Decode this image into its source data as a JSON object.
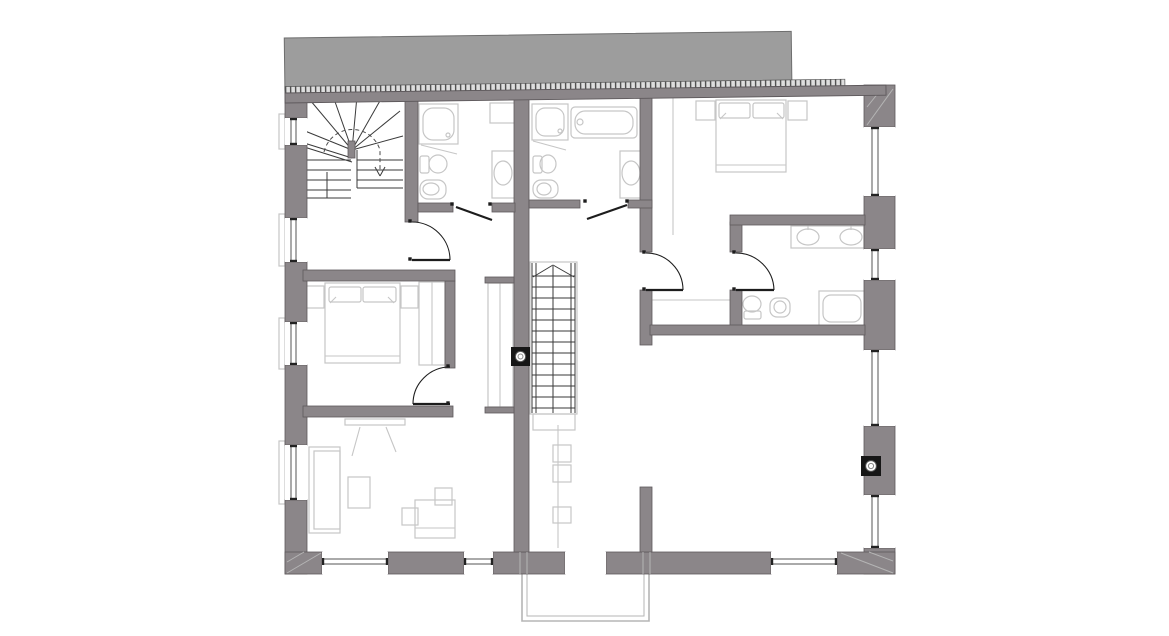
{
  "meta": {
    "width": 1169,
    "height": 636
  },
  "colors": {
    "bg": "#ffffff",
    "wall": "#8b8689",
    "wallEdge": "#5e595c",
    "roof": "#9d9d9d",
    "roofEdge": "#6e6e6e",
    "hatchBg": "#dedede",
    "hatchTick": "#4f4f4f",
    "light": "#c6c6c6",
    "mid": "#b5b5b5",
    "dark": "#3a3a3a",
    "door": "#1d1d1d",
    "window": "#ffffff",
    "frame": "#555555",
    "cap": "#222222"
  },
  "roof": {
    "rot": -0.75,
    "ox": 285,
    "oy": 95,
    "block": [
      285,
      38,
      507,
      52
    ],
    "hatch": [
      285,
      86.5,
      560,
      6.5
    ],
    "band": [
      285,
      93,
      601,
      10
    ]
  },
  "balcony": [
    "M522,570 L522,621 L649,621 L649,570",
    "M527,570 L527,616 L644,616 L644,570"
  ],
  "walls": [
    [
      285,
      90,
      22,
      28,
      "left-pier-1"
    ],
    [
      285,
      145,
      22,
      73,
      "left-pier-2"
    ],
    [
      285,
      262,
      22,
      60,
      "left-pier-3"
    ],
    [
      285,
      365,
      22,
      80,
      "left-pier-4"
    ],
    [
      285,
      500,
      22,
      74,
      "left-pier-5"
    ],
    [
      864,
      85,
      31,
      42,
      "right-pier-1"
    ],
    [
      864,
      196,
      31,
      53,
      "right-pier-2"
    ],
    [
      864,
      280,
      31,
      70,
      "right-pier-3"
    ],
    [
      864,
      426,
      31,
      69,
      "right-pier-4"
    ],
    [
      864,
      548,
      31,
      26,
      "right-pier-5"
    ],
    [
      285,
      552,
      37,
      22,
      "bottom-wall-seg-1"
    ],
    [
      388,
      552,
      76,
      22,
      "bottom-wall-seg-2"
    ],
    [
      493,
      552,
      72,
      22,
      "bottom-wall-seg-3"
    ],
    [
      606,
      552,
      165,
      22,
      "bottom-wall-seg-4"
    ],
    [
      837,
      552,
      58,
      22,
      "bottom-wall-seg-5"
    ],
    [
      405,
      95,
      13,
      127,
      "stairhall-east-wall"
    ],
    [
      514,
      95,
      15,
      457,
      "central-spine-wall"
    ],
    [
      640,
      95,
      12,
      157,
      "corridor-east-wall-upper"
    ],
    [
      640,
      290,
      12,
      55,
      "corridor-east-wall-mid"
    ],
    [
      640,
      487,
      12,
      65,
      "corridor-east-wall-lower"
    ],
    [
      445,
      281,
      10,
      87,
      "bedroom-left-east-wall"
    ],
    [
      730,
      222,
      12,
      30,
      "ensuite-west-stub-upper"
    ],
    [
      730,
      290,
      12,
      40,
      "ensuite-west-stub-lower"
    ],
    [
      303,
      270,
      152,
      11,
      "bedroom-left-north-wall"
    ],
    [
      303,
      406,
      150,
      11,
      "bedroom-left-south-wall"
    ],
    [
      418,
      203,
      35,
      9,
      "bath1-south-wall-a"
    ],
    [
      492,
      203,
      23,
      9,
      "bath1-south-wall-b"
    ],
    [
      529,
      200,
      51,
      8,
      "bath2-south-wall-a"
    ],
    [
      628,
      200,
      24,
      8,
      "bath2-south-wall-b"
    ],
    [
      730,
      215,
      135,
      10,
      "ensuite-north-wall"
    ],
    [
      650,
      325,
      215,
      10,
      "ensuite-south-wall"
    ],
    [
      485,
      277,
      29,
      6,
      "closet-stub-north"
    ],
    [
      485,
      407,
      29,
      6,
      "closet-stub-south"
    ],
    [
      348,
      141,
      7,
      17,
      "winder-newel"
    ]
  ],
  "windows": [
    {
      "o": "v",
      "x": 285,
      "y": 118,
      "w": 22,
      "h": 27,
      "f": [
        291,
        296
      ],
      "n": "window-left-1"
    },
    {
      "o": "v",
      "x": 285,
      "y": 218,
      "w": 22,
      "h": 44,
      "f": [
        291,
        296
      ],
      "n": "window-left-2"
    },
    {
      "o": "v",
      "x": 285,
      "y": 322,
      "w": 22,
      "h": 43,
      "f": [
        291,
        296
      ],
      "n": "window-left-3"
    },
    {
      "o": "v",
      "x": 285,
      "y": 445,
      "w": 22,
      "h": 55,
      "f": [
        291,
        296
      ],
      "n": "window-left-4"
    },
    {
      "o": "v",
      "x": 864,
      "y": 127,
      "w": 31,
      "h": 69,
      "f": [
        872,
        878
      ],
      "n": "window-right-1"
    },
    {
      "o": "v",
      "x": 864,
      "y": 249,
      "w": 31,
      "h": 31,
      "f": [
        872,
        878
      ],
      "n": "window-right-2"
    },
    {
      "o": "v",
      "x": 864,
      "y": 350,
      "w": 31,
      "h": 76,
      "f": [
        872,
        878
      ],
      "n": "window-right-3"
    },
    {
      "o": "v",
      "x": 864,
      "y": 495,
      "w": 31,
      "h": 53,
      "f": [
        872,
        878
      ],
      "n": "window-right-4"
    },
    {
      "o": "h",
      "x": 322,
      "y": 552,
      "w": 66,
      "h": 22,
      "f": [
        559,
        564
      ],
      "n": "window-bottom-1"
    },
    {
      "o": "h",
      "x": 464,
      "y": 552,
      "w": 29,
      "h": 22,
      "f": [
        559,
        564
      ],
      "n": "window-bottom-2"
    },
    {
      "o": "h",
      "x": 771,
      "y": 552,
      "w": 66,
      "h": 22,
      "f": [
        559,
        564
      ],
      "n": "window-bottom-3"
    },
    {
      "o": "h",
      "x": 565,
      "y": 552,
      "w": 41,
      "h": 22,
      "f": [],
      "n": "balcony-door-opening"
    }
  ],
  "lightRects": [
    [
      419,
      104,
      39,
      40,
      0,
      "shower-tray-1"
    ],
    [
      423,
      108,
      31,
      32,
      10,
      "shower-tray-1-inner"
    ],
    [
      532,
      104,
      36,
      36,
      0,
      "shower-tray-2"
    ],
    [
      536,
      108,
      28,
      28,
      9,
      "shower-tray-2-inner"
    ],
    [
      819,
      291,
      46,
      35,
      0,
      "shower-tray-3"
    ],
    [
      823,
      295,
      38,
      27,
      8,
      "shower-tray-3-inner"
    ],
    [
      571,
      107,
      66,
      31,
      4,
      "bathtub"
    ],
    [
      575,
      111,
      58,
      23,
      10,
      "bathtub-inner"
    ],
    [
      492,
      151,
      23,
      47,
      0,
      "bath1-sink-counter"
    ],
    [
      620,
      151,
      22,
      47,
      0,
      "bath2-sink-counter"
    ],
    [
      791,
      226,
      73,
      22,
      0,
      "ensuite-vanity"
    ],
    [
      490,
      103,
      25,
      20,
      0,
      "bath1-shelf"
    ],
    [
      420,
      156,
      9,
      17,
      2,
      "toilet1-tank"
    ],
    [
      533,
      156,
      9,
      17,
      2,
      "toilet2-tank"
    ],
    [
      420,
      180,
      26,
      19,
      8,
      "bidet1-body"
    ],
    [
      533,
      180,
      25,
      18,
      8,
      "bidet2-body"
    ],
    [
      744,
      311,
      17,
      8,
      2,
      "toilet3-tank"
    ],
    [
      770,
      298,
      20,
      19,
      7,
      "bidet3-body"
    ],
    [
      325,
      283,
      75,
      80,
      0,
      "bed-left"
    ],
    [
      329,
      287,
      32,
      15,
      2,
      "bed-left-pillow-1"
    ],
    [
      363,
      287,
      33,
      15,
      2,
      "bed-left-pillow-2"
    ],
    [
      306,
      286,
      18,
      22,
      0,
      "nightstand-left-1"
    ],
    [
      401,
      286,
      17,
      22,
      0,
      "nightstand-left-2"
    ],
    [
      419,
      282,
      26,
      83,
      0,
      "wardrobe-left"
    ],
    [
      716,
      100,
      70,
      72,
      0,
      "bed-right"
    ],
    [
      719,
      103,
      31,
      15,
      2,
      "bed-right-pillow-1"
    ],
    [
      753,
      103,
      31,
      15,
      2,
      "bed-right-pillow-2"
    ],
    [
      696,
      101,
      19,
      19,
      0,
      "nightstand-right-1"
    ],
    [
      788,
      101,
      19,
      19,
      0,
      "nightstand-right-2"
    ],
    [
      488,
      283,
      25,
      124,
      0,
      "corridor-closet"
    ],
    [
      309,
      447,
      31,
      86,
      0,
      "sofa"
    ],
    [
      314,
      451,
      26,
      78,
      0,
      "sofa-inner"
    ],
    [
      348,
      477,
      22,
      31,
      0,
      "coffee-table"
    ],
    [
      435,
      488,
      17,
      17,
      0,
      "side-table"
    ],
    [
      415,
      500,
      40,
      38,
      0,
      "desk"
    ],
    [
      402,
      508,
      16,
      17,
      0,
      "desk-chair"
    ],
    [
      553,
      445,
      18,
      17,
      0,
      "corridor-box-1"
    ],
    [
      553,
      465,
      18,
      17,
      0,
      "corridor-box-2"
    ],
    [
      553,
      507,
      18,
      16,
      0,
      "corridor-box-3"
    ],
    [
      530,
      262,
      47,
      152,
      0,
      "stair-outline"
    ],
    [
      533,
      414,
      42,
      16,
      0,
      "stair-landing-outline"
    ],
    [
      345,
      419,
      60,
      6,
      0,
      "tv"
    ],
    [
      279,
      114,
      6,
      35,
      0,
      "sill-left-1"
    ],
    [
      279,
      214,
      6,
      52,
      0,
      "sill-left-2"
    ],
    [
      279,
      318,
      6,
      51,
      0,
      "sill-left-3"
    ],
    [
      279,
      441,
      6,
      63,
      0,
      "sill-left-4"
    ]
  ],
  "lightEllipses": [
    [
      503,
      173,
      9,
      12,
      "bath1-sink-bowl"
    ],
    [
      631,
      173,
      9,
      12,
      "bath2-sink-bowl"
    ],
    [
      808,
      237,
      11,
      8,
      "vanity-sink-1"
    ],
    [
      851,
      237,
      11,
      8,
      "vanity-sink-2"
    ],
    [
      438,
      164,
      9,
      9,
      "toilet1-bowl"
    ],
    [
      548,
      164,
      8,
      9,
      "toilet2-bowl"
    ],
    [
      431,
      189,
      8,
      6,
      "bidet1-bowl"
    ],
    [
      544,
      189,
      7,
      6,
      "bidet2-bowl"
    ],
    [
      752,
      304,
      9,
      8,
      "toilet3-bowl"
    ],
    [
      780,
      307,
      6,
      6,
      "bidet3-bowl"
    ],
    [
      580,
      122,
      3,
      3,
      "bathtub-faucet"
    ],
    [
      448,
      135,
      2,
      2,
      "shower1-drain"
    ],
    [
      560,
      131,
      2,
      2,
      "shower2-drain"
    ]
  ],
  "lightLines": [
    [
      421,
      145,
      457,
      154
    ],
    [
      533,
      141,
      566,
      150
    ],
    [
      330,
      303,
      336,
      297
    ],
    [
      394,
      303,
      388,
      297
    ],
    [
      720,
      119,
      726,
      113
    ],
    [
      783,
      119,
      777,
      113
    ],
    [
      325,
      356,
      400,
      356
    ],
    [
      716,
      165,
      786,
      165
    ],
    [
      360,
      427,
      352,
      456
    ],
    [
      386,
      427,
      396,
      452
    ],
    [
      415,
      528,
      455,
      528
    ],
    [
      673,
      98,
      673,
      235
    ],
    [
      652,
      300,
      730,
      300
    ],
    [
      558,
      425,
      558,
      548
    ],
    [
      432,
      282,
      432,
      365
    ],
    [
      500,
      283,
      500,
      407
    ],
    [
      808,
      230,
      808,
      225
    ],
    [
      851,
      230,
      851,
      225
    ]
  ],
  "darkLines": [
    [
      352,
      150,
      305,
      131
    ],
    [
      352,
      150,
      310,
      100
    ],
    [
      352,
      150,
      333,
      96
    ],
    [
      352,
      150,
      357,
      96
    ],
    [
      352,
      150,
      381,
      99
    ],
    [
      352,
      150,
      400,
      111
    ],
    [
      352,
      150,
      403,
      136
    ],
    [
      307,
      160,
      351,
      160
    ],
    [
      307,
      170,
      351,
      170
    ],
    [
      307,
      180,
      351,
      180
    ],
    [
      307,
      190,
      351,
      190
    ],
    [
      307,
      198,
      351,
      198
    ],
    [
      327,
      172,
      327,
      198
    ],
    [
      357,
      160,
      403,
      160
    ],
    [
      357,
      170,
      403,
      170
    ],
    [
      357,
      180,
      403,
      180
    ],
    [
      357,
      188,
      403,
      188
    ],
    [
      357,
      150,
      357,
      188
    ],
    [
      301,
      146,
      352,
      162
    ],
    [
      301,
      142,
      352,
      158
    ],
    [
      375,
      167,
      380,
      176
    ],
    [
      385,
      167,
      380,
      176
    ],
    [
      532,
      263,
      532,
      413
    ],
    [
      536,
      263,
      536,
      413
    ],
    [
      571,
      263,
      571,
      413
    ],
    [
      575,
      263,
      575,
      413
    ],
    [
      553,
      266,
      553,
      413
    ],
    [
      532,
      276,
      575,
      276
    ],
    [
      532,
      287,
      575,
      287
    ],
    [
      532,
      298,
      575,
      298
    ],
    [
      532,
      309,
      575,
      309
    ],
    [
      532,
      320,
      575,
      320
    ],
    [
      532,
      331,
      575,
      331
    ],
    [
      532,
      342,
      575,
      342
    ],
    [
      532,
      353,
      575,
      353
    ],
    [
      532,
      364,
      575,
      364
    ],
    [
      532,
      375,
      575,
      375
    ],
    [
      532,
      386,
      575,
      386
    ],
    [
      532,
      397,
      575,
      397
    ],
    [
      532,
      408,
      575,
      408
    ],
    [
      533,
      277,
      553,
      265
    ],
    [
      553,
      265,
      574,
      277
    ]
  ],
  "dashedPaths": [
    "M324,152 A29,29 0 0 1 380,150 L380,172"
  ],
  "overLines": [
    [
      287,
      573,
      321,
      553
    ],
    [
      287,
      562,
      304,
      552
    ],
    [
      893,
      573,
      841,
      553
    ],
    [
      893,
      561,
      869,
      552
    ],
    [
      867,
      125,
      893,
      89
    ],
    [
      867,
      107,
      883,
      87
    ],
    [
      520,
      552,
      520,
      574
    ],
    [
      527,
      552,
      527,
      574
    ],
    [
      643,
      552,
      643,
      574
    ],
    [
      650,
      552,
      650,
      574
    ]
  ],
  "doorArcs": [
    "M412,222 A38,38 0 0 1 450,260",
    "M450,367 A37,37 0 0 0 413,404",
    "M646,253 A37,37 0 0 1 683,290",
    "M736,253 A38,38 0 0 1 774,290"
  ],
  "doorLeaves": [
    [
      412,
      260,
      450,
      260,
      "door-stairhall-leaf"
    ],
    [
      450,
      404,
      413,
      404,
      "door-bedroom-left-leaf"
    ],
    [
      646,
      290,
      683,
      290,
      "door-landing-bedroom-leaf"
    ],
    [
      736,
      290,
      774,
      290,
      "door-ensuite-leaf"
    ],
    [
      456,
      207,
      492,
      220,
      "door-bath1-leaf"
    ],
    [
      627,
      205,
      587,
      219,
      "door-bath2-leaf"
    ]
  ],
  "doorDots": [
    [
      410,
      221
    ],
    [
      410,
      259
    ],
    [
      448,
      366
    ],
    [
      448,
      403
    ],
    [
      644,
      252
    ],
    [
      644,
      289
    ],
    [
      734,
      252
    ],
    [
      734,
      289
    ],
    [
      452,
      204
    ],
    [
      490,
      204
    ],
    [
      585,
      201
    ],
    [
      627,
      201
    ]
  ],
  "columns": [
    [
      520.5,
      356.5,
      19,
      "column-symbol-1"
    ],
    [
      871,
      466,
      20,
      "column-symbol-2"
    ]
  ]
}
